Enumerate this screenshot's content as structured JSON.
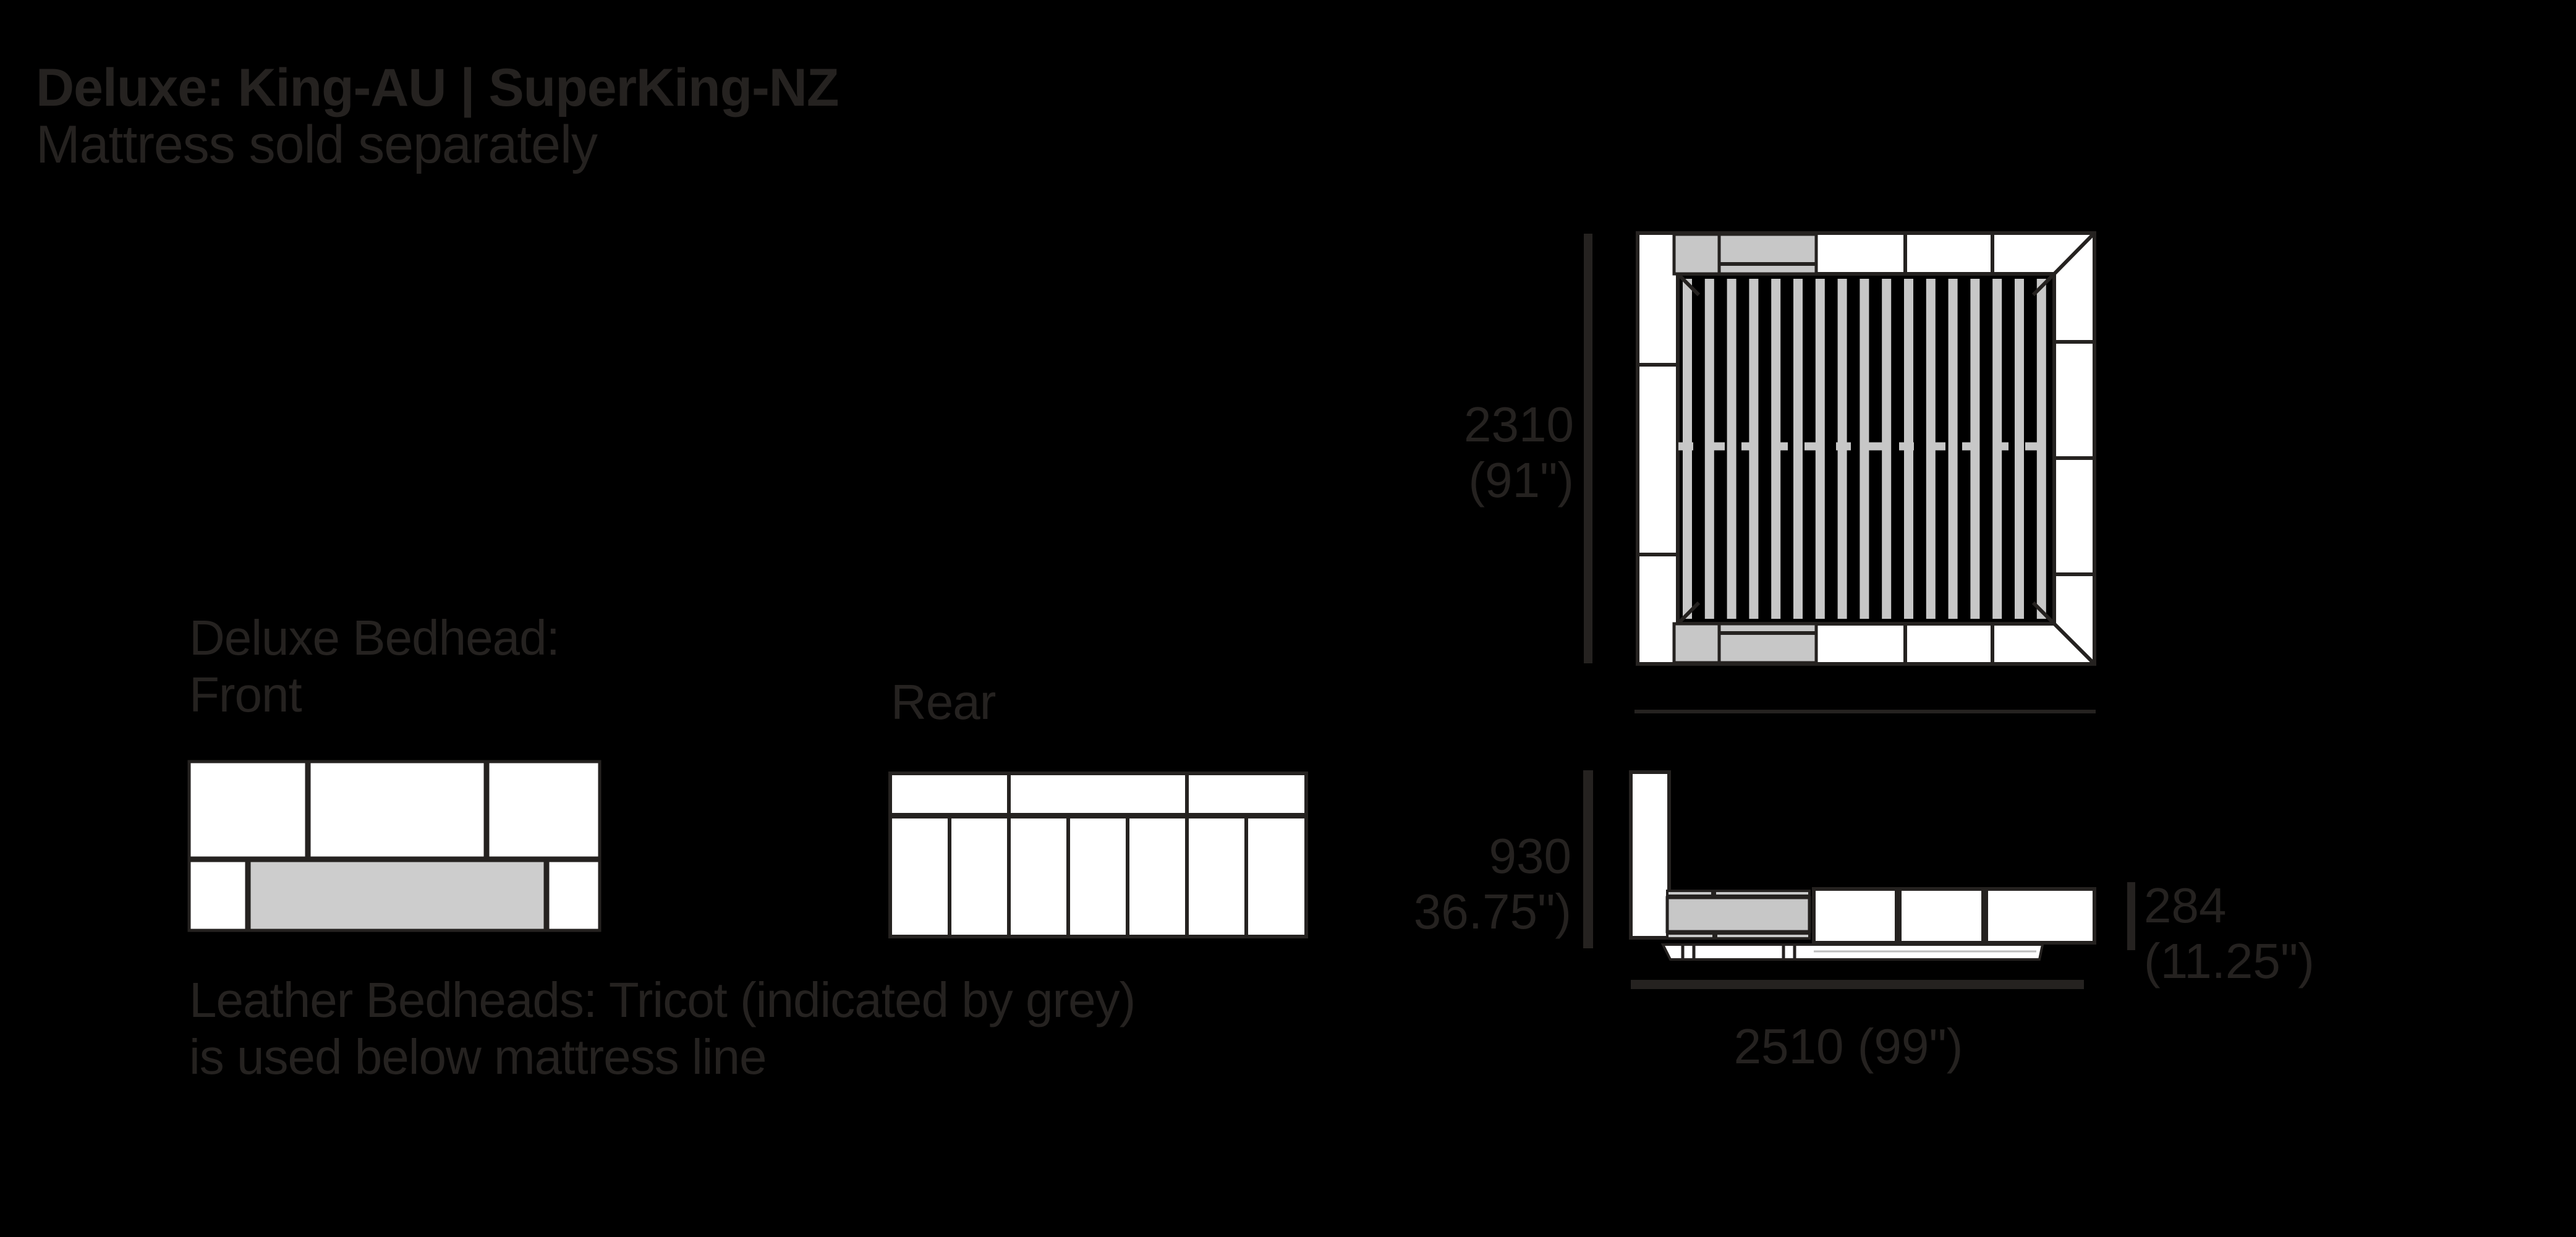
{
  "header": {
    "title": "Deluxe: King-AU | SuperKing-NZ",
    "subtitle": "Mattress sold separately"
  },
  "labels": {
    "front_view_line1": "Deluxe Bedhead:",
    "front_view_line2": "Front",
    "rear_view": "Rear",
    "note_line1": "Leather Bedheads: Tricot (indicated by grey)",
    "note_line2": "is used below mattress line"
  },
  "dimensions": {
    "plan_width_mm": "2310",
    "plan_width_in": "(91\")",
    "bedhead_height_mm": "930",
    "bedhead_height_in": "36.75\")",
    "platform_height_mm": "284",
    "platform_height_in": "(11.25\")",
    "overall_length": "2510 (99\")"
  },
  "views": {
    "front": "bedhead-front-elevation",
    "rear": "bedhead-rear-elevation",
    "plan": "bed-top-plan-with-slats",
    "side": "bed-side-elevation"
  },
  "colors": {
    "background": "#000000",
    "ink": "#252220",
    "panel_white": "#ffffff",
    "tricot_grey": "#cdcdcd",
    "slat_grey": "#c7c7c7"
  }
}
